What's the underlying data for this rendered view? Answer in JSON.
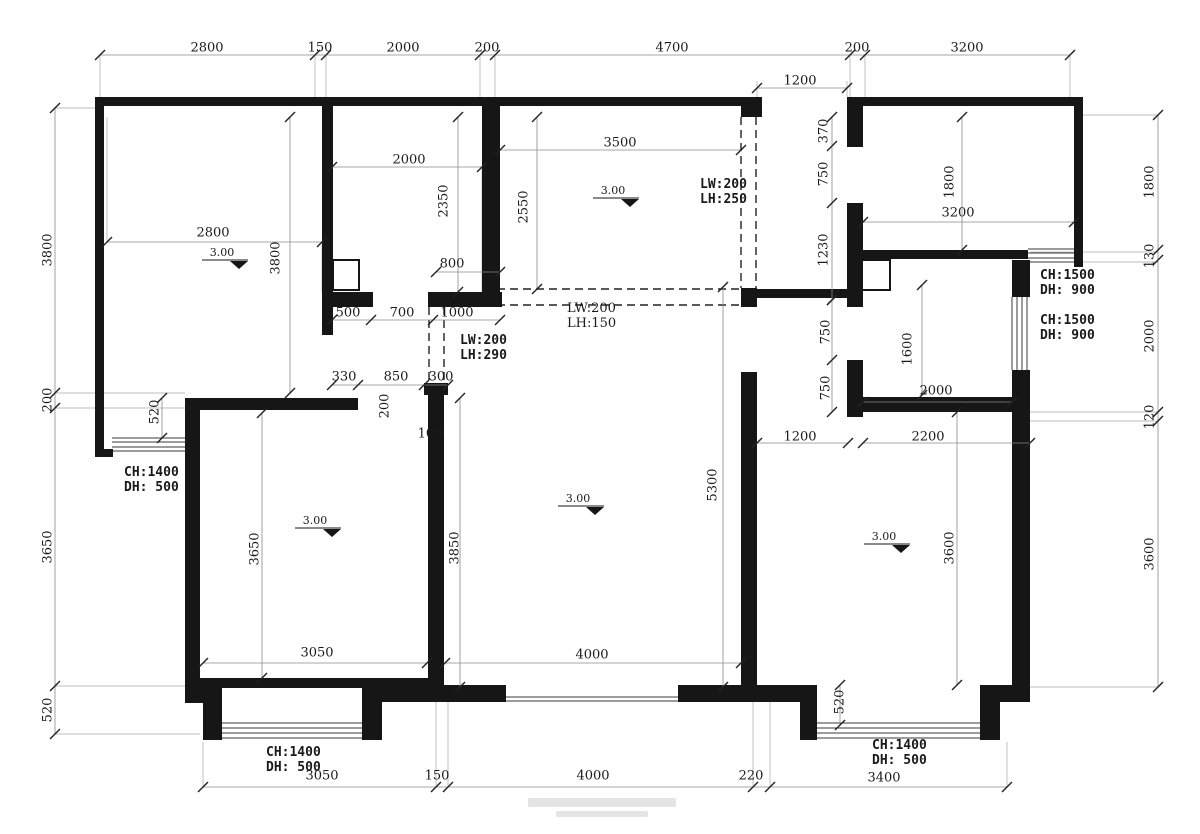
{
  "meta": {
    "drawing_type": "apartment-floor-plan-dimension-drawing"
  },
  "canvas": {
    "w": 1200,
    "h": 834,
    "bg": "#ffffff",
    "ink": "#161616",
    "dimline": "#8a8a8a",
    "tick": "#222222",
    "ext": "#a8a8a8",
    "hatch": "#3a3a3a",
    "dash": "#222222",
    "text": "#1a1a1a",
    "watermark": "#e4e4e4"
  },
  "walls": [
    [
      95,
      97,
      667,
      9
    ],
    [
      847,
      97,
      236,
      9
    ],
    [
      1074,
      97,
      9,
      170
    ],
    [
      95,
      97,
      9,
      360
    ],
    [
      95,
      449,
      18,
      8
    ],
    [
      322,
      106,
      11,
      201
    ],
    [
      322,
      307,
      11,
      28
    ],
    [
      322,
      292,
      51,
      15
    ],
    [
      428,
      292,
      74,
      15
    ],
    [
      482,
      106,
      18,
      201
    ],
    [
      741,
      288,
      16,
      19
    ],
    [
      741,
      289,
      121,
      9
    ],
    [
      847,
      106,
      16,
      41
    ],
    [
      847,
      203,
      16,
      104
    ],
    [
      860,
      250,
      168,
      9
    ],
    [
      1012,
      260,
      18,
      37
    ],
    [
      1012,
      370,
      18,
      332
    ],
    [
      862,
      397,
      150,
      15
    ],
    [
      847,
      360,
      16,
      57
    ],
    [
      741,
      372,
      16,
      315
    ],
    [
      428,
      393,
      16,
      294
    ],
    [
      424,
      383,
      24,
      12
    ],
    [
      185,
      398,
      173,
      12
    ],
    [
      185,
      398,
      15,
      297
    ],
    [
      185,
      683,
      37,
      20
    ],
    [
      203,
      700,
      19,
      40
    ],
    [
      362,
      683,
      20,
      57
    ],
    [
      200,
      678,
      230,
      10
    ],
    [
      362,
      685,
      144,
      17
    ],
    [
      678,
      685,
      139,
      17
    ],
    [
      800,
      685,
      17,
      55
    ],
    [
      980,
      685,
      32,
      17
    ],
    [
      980,
      702,
      20,
      38
    ],
    [
      741,
      97,
      21,
      20
    ],
    [
      847,
      97,
      16,
      20
    ]
  ],
  "boxes": [
    [
      333,
      260,
      26,
      30
    ],
    [
      862,
      260,
      28,
      30
    ]
  ],
  "dash_pairs": [
    [
      429,
      307,
      429,
      383
    ],
    [
      444,
      307,
      444,
      383
    ],
    [
      741,
      117,
      741,
      288
    ],
    [
      756,
      117,
      756,
      288
    ],
    [
      484,
      289,
      741,
      289
    ],
    [
      484,
      305,
      741,
      305
    ]
  ],
  "hatches": [
    {
      "o": "h",
      "from": 112,
      "to": 186,
      "pos": [
        438,
        442,
        447,
        451
      ]
    },
    {
      "o": "h",
      "from": 222,
      "to": 362,
      "pos": [
        723,
        728,
        733,
        738
      ]
    },
    {
      "o": "h",
      "from": 817,
      "to": 980,
      "pos": [
        723,
        728,
        733,
        738
      ]
    },
    {
      "o": "h",
      "from": 1028,
      "to": 1074,
      "pos": [
        249,
        253,
        258,
        262
      ]
    },
    {
      "o": "v",
      "from": 297,
      "to": 370,
      "pos": [
        1012,
        1017,
        1022,
        1027
      ]
    },
    {
      "o": "h",
      "from": 506,
      "to": 678,
      "pos": [
        697,
        701
      ]
    }
  ],
  "ext_lines": [
    [
      315,
      55,
      315,
      106
    ],
    [
      326,
      55,
      326,
      106
    ],
    [
      480,
      55,
      480,
      106
    ],
    [
      495,
      55,
      495,
      106
    ],
    [
      850,
      55,
      850,
      97
    ],
    [
      865,
      55,
      865,
      97
    ],
    [
      100,
      55,
      100,
      97
    ],
    [
      1070,
      55,
      1070,
      97
    ],
    [
      757,
      81,
      757,
      97
    ],
    [
      847,
      81,
      847,
      97
    ],
    [
      55,
      108,
      95,
      108
    ],
    [
      55,
      393,
      185,
      393
    ],
    [
      55,
      408,
      185,
      408
    ],
    [
      55,
      686,
      185,
      686
    ],
    [
      55,
      734,
      200,
      734
    ],
    [
      1083,
      115,
      1158,
      115
    ],
    [
      1030,
      252,
      1158,
      252
    ],
    [
      1030,
      262,
      1158,
      262
    ],
    [
      1012,
      412,
      1158,
      412
    ],
    [
      1012,
      421,
      1158,
      421
    ],
    [
      1030,
      687,
      1158,
      687
    ],
    [
      203,
      742,
      203,
      787
    ],
    [
      436,
      687,
      436,
      787
    ],
    [
      448,
      687,
      448,
      787
    ],
    [
      753,
      702,
      753,
      787
    ],
    [
      770,
      702,
      770,
      787
    ],
    [
      1007,
      742,
      1007,
      787
    ],
    [
      107,
      117,
      107,
      242
    ],
    [
      322,
      242,
      322,
      292
    ],
    [
      332,
      167,
      332,
      292
    ],
    [
      482,
      167,
      482,
      292
    ]
  ],
  "dim_lines": [
    {
      "l": [
        100,
        55,
        1070,
        55
      ],
      "t": [
        100,
        315,
        326,
        480,
        495,
        850,
        865,
        1070
      ]
    },
    {
      "l": [
        757,
        88,
        847,
        88
      ],
      "t": [
        757,
        847
      ]
    },
    {
      "l": [
        55,
        108,
        55,
        734
      ],
      "t": [
        108,
        393,
        408,
        686,
        734
      ]
    },
    {
      "l": [
        1158,
        115,
        1158,
        687
      ],
      "t": [
        115,
        250,
        260,
        412,
        421,
        687
      ]
    },
    {
      "l": [
        203,
        787,
        1007,
        787
      ],
      "t": [
        203,
        436,
        448,
        753,
        770,
        1007
      ]
    },
    {
      "l": [
        107,
        242,
        322,
        242
      ],
      "t": [
        107,
        322
      ]
    },
    {
      "l": [
        332,
        167,
        482,
        167
      ],
      "t": [
        332,
        482
      ]
    },
    {
      "l": [
        458,
        117,
        458,
        292
      ],
      "t": [
        117,
        292
      ]
    },
    {
      "l": [
        436,
        272,
        500,
        272
      ],
      "t": [
        436,
        500
      ]
    },
    {
      "l": [
        290,
        117,
        290,
        393
      ],
      "t": [
        117,
        393
      ]
    },
    {
      "l": [
        500,
        150,
        741,
        150
      ],
      "t": [
        500,
        741
      ]
    },
    {
      "l": [
        537,
        117,
        537,
        289
      ],
      "t": [
        117,
        289
      ]
    },
    {
      "l": [
        332,
        320,
        500,
        320
      ],
      "t": [
        332,
        371,
        433,
        500
      ]
    },
    {
      "l": [
        332,
        385,
        448,
        385
      ],
      "t": [
        332,
        358,
        424,
        448
      ]
    },
    {
      "l": [
        832,
        117,
        832,
        300
      ],
      "t": [
        117,
        146,
        203,
        300
      ]
    },
    {
      "l": [
        832,
        300,
        832,
        412
      ],
      "t": [
        300,
        360,
        412
      ]
    },
    {
      "l": [
        962,
        117,
        962,
        250
      ],
      "t": [
        117,
        250
      ]
    },
    {
      "l": [
        863,
        222,
        1074,
        222
      ],
      "t": [
        863,
        1074
      ]
    },
    {
      "l": [
        922,
        285,
        922,
        395
      ],
      "t": [
        285,
        395
      ]
    },
    {
      "l": [
        863,
        402,
        1012,
        402
      ],
      "t": [
        863,
        1012
      ]
    },
    {
      "l": [
        757,
        443,
        848,
        443
      ],
      "t": [
        757,
        848
      ]
    },
    {
      "l": [
        863,
        443,
        1030,
        443
      ],
      "t": [
        863,
        1030
      ]
    },
    {
      "l": [
        460,
        398,
        460,
        687
      ],
      "t": [
        398,
        687
      ]
    },
    {
      "l": [
        723,
        287,
        723,
        687
      ],
      "t": [
        287,
        687
      ]
    },
    {
      "l": [
        262,
        413,
        262,
        678
      ],
      "t": [
        413,
        678
      ]
    },
    {
      "l": [
        203,
        663,
        427,
        663
      ],
      "t": [
        203,
        427
      ]
    },
    {
      "l": [
        445,
        663,
        741,
        663
      ],
      "t": [
        445,
        741
      ]
    },
    {
      "l": [
        957,
        412,
        957,
        685
      ],
      "t": [
        412,
        685
      ]
    },
    {
      "l": [
        840,
        685,
        840,
        725
      ],
      "t": [
        685,
        725
      ]
    },
    {
      "l": [
        162,
        398,
        162,
        438
      ],
      "t": [
        398,
        438
      ]
    }
  ],
  "dim_texts": [
    {
      "t": "2800",
      "x": 207,
      "y": 48
    },
    {
      "t": "150",
      "x": 320,
      "y": 48
    },
    {
      "t": "2000",
      "x": 403,
      "y": 48
    },
    {
      "t": "200",
      "x": 487,
      "y": 48
    },
    {
      "t": "4700",
      "x": 672,
      "y": 48
    },
    {
      "t": "200",
      "x": 857,
      "y": 48
    },
    {
      "t": "3200",
      "x": 967,
      "y": 48
    },
    {
      "t": "1200",
      "x": 800,
      "y": 81
    },
    {
      "t": "3800",
      "x": 48,
      "y": 250,
      "r": 1
    },
    {
      "t": "200",
      "x": 48,
      "y": 400,
      "r": 1
    },
    {
      "t": "3650",
      "x": 48,
      "y": 547,
      "r": 1
    },
    {
      "t": "520",
      "x": 48,
      "y": 710,
      "r": 1
    },
    {
      "t": "1800",
      "x": 1150,
      "y": 182,
      "r": 1
    },
    {
      "t": "130",
      "x": 1150,
      "y": 256,
      "r": 1
    },
    {
      "t": "2000",
      "x": 1150,
      "y": 336,
      "r": 1
    },
    {
      "t": "120",
      "x": 1150,
      "y": 417,
      "r": 1
    },
    {
      "t": "3600",
      "x": 1150,
      "y": 554,
      "r": 1
    },
    {
      "t": "3050",
      "x": 322,
      "y": 776
    },
    {
      "t": "150",
      "x": 437,
      "y": 776
    },
    {
      "t": "4000",
      "x": 593,
      "y": 776
    },
    {
      "t": "220",
      "x": 751,
      "y": 776
    },
    {
      "t": "3400",
      "x": 884,
      "y": 778
    },
    {
      "t": "2800",
      "x": 213,
      "y": 233
    },
    {
      "t": "3800",
      "x": 276,
      "y": 258,
      "r": 1
    },
    {
      "t": "2000",
      "x": 409,
      "y": 160
    },
    {
      "t": "2350",
      "x": 444,
      "y": 201,
      "r": 1
    },
    {
      "t": "800",
      "x": 452,
      "y": 264
    },
    {
      "t": "500",
      "x": 348,
      "y": 313
    },
    {
      "t": "700",
      "x": 402,
      "y": 313
    },
    {
      "t": "1000",
      "x": 457,
      "y": 313
    },
    {
      "t": "330",
      "x": 344,
      "y": 377
    },
    {
      "t": "850",
      "x": 396,
      "y": 377
    },
    {
      "t": "300",
      "x": 441,
      "y": 377
    },
    {
      "t": "200",
      "x": 385,
      "y": 406,
      "r": 1
    },
    {
      "t": "100",
      "x": 430,
      "y": 434
    },
    {
      "t": "3500",
      "x": 620,
      "y": 143
    },
    {
      "t": "2550",
      "x": 524,
      "y": 207,
      "r": 1
    },
    {
      "t": "1200",
      "x": 800,
      "y": 437
    },
    {
      "t": "2200",
      "x": 928,
      "y": 437
    },
    {
      "t": "370",
      "x": 824,
      "y": 131,
      "r": 1
    },
    {
      "t": "750",
      "x": 824,
      "y": 174,
      "r": 1
    },
    {
      "t": "1230",
      "x": 824,
      "y": 250,
      "r": 1
    },
    {
      "t": "750",
      "x": 826,
      "y": 332,
      "r": 1
    },
    {
      "t": "750",
      "x": 826,
      "y": 388,
      "r": 1
    },
    {
      "t": "1800",
      "x": 950,
      "y": 182,
      "r": 1
    },
    {
      "t": "3200",
      "x": 958,
      "y": 213
    },
    {
      "t": "1600",
      "x": 908,
      "y": 349,
      "r": 1
    },
    {
      "t": "2000",
      "x": 936,
      "y": 391
    },
    {
      "t": "3850",
      "x": 455,
      "y": 548,
      "r": 1
    },
    {
      "t": "5300",
      "x": 713,
      "y": 485,
      "r": 1
    },
    {
      "t": "3650",
      "x": 255,
      "y": 549,
      "r": 1
    },
    {
      "t": "3050",
      "x": 317,
      "y": 653
    },
    {
      "t": "4000",
      "x": 592,
      "y": 655
    },
    {
      "t": "3600",
      "x": 950,
      "y": 548,
      "r": 1
    },
    {
      "t": "520",
      "x": 840,
      "y": 702,
      "r": 1
    },
    {
      "t": "520",
      "x": 155,
      "y": 412,
      "r": 1
    }
  ],
  "annotations": [
    {
      "lines": [
        "CH:1400",
        "DH:  500"
      ],
      "x": 124,
      "y": 476,
      "bold": true
    },
    {
      "lines": [
        "CH:1400",
        "DH:  500"
      ],
      "x": 266,
      "y": 756,
      "bold": true
    },
    {
      "lines": [
        "CH:1400",
        "DH:  500"
      ],
      "x": 872,
      "y": 749,
      "bold": true
    },
    {
      "lines": [
        "CH:1500",
        "DH:  900"
      ],
      "x": 1040,
      "y": 279,
      "bold": true
    },
    {
      "lines": [
        "CH:1500",
        "DH:  900"
      ],
      "x": 1040,
      "y": 324,
      "bold": true
    },
    {
      "lines": [
        "LW:200",
        "LH:250"
      ],
      "x": 700,
      "y": 188,
      "bold": true
    },
    {
      "lines": [
        "LW:200",
        "LH:290"
      ],
      "x": 460,
      "y": 344,
      "bold": true
    },
    {
      "lines": [
        "LW:200",
        "LH:150"
      ],
      "x": 567,
      "y": 312,
      "bold": false
    }
  ],
  "level_markers": [
    {
      "label": "3.00",
      "x": 222,
      "y": 256
    },
    {
      "label": "3.00",
      "x": 613,
      "y": 194
    },
    {
      "label": "3.00",
      "x": 578,
      "y": 502
    },
    {
      "label": "3.00",
      "x": 315,
      "y": 524
    },
    {
      "label": "3.00",
      "x": 884,
      "y": 540
    }
  ],
  "watermark_blocks": [
    [
      528,
      798,
      148,
      9
    ],
    [
      556,
      811,
      92,
      6
    ]
  ]
}
